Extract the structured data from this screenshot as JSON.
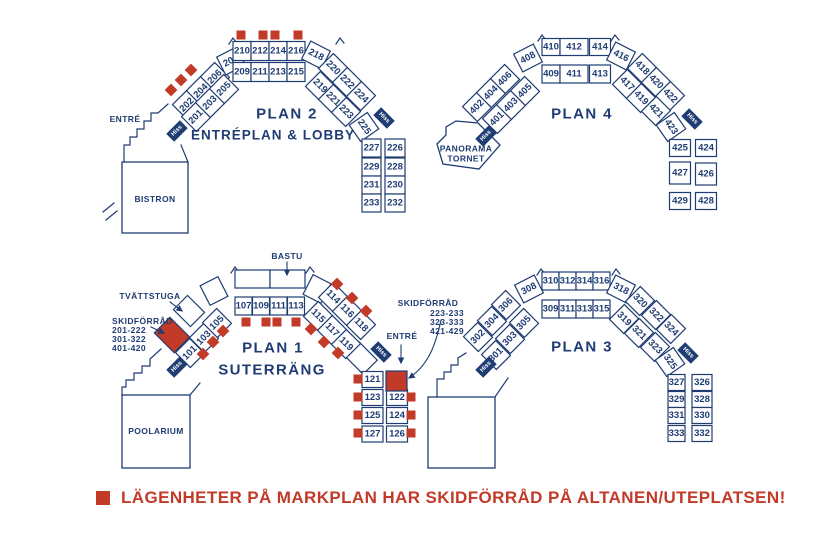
{
  "colors": {
    "navy": "#1f3c73",
    "red": "#c23a28",
    "background": "#ffffff"
  },
  "legend": {
    "text": "LÄGENHETER PÅ MARKPLAN HAR SKIDFÖRRÅD PÅ ALTANEN/UTEPLATSEN!"
  },
  "labels": {
    "hiss": "Hiss",
    "entre_plan2": "ENTRÉ",
    "entre_plan1": "ENTRÉ",
    "bistron": "BISTRON",
    "poolarium": "POOLARIUM",
    "panorama_tornet": "PANORAMA\nTORNET",
    "bastu": "BASTU",
    "tvattstuga": "TVÄTTSTUGA",
    "skidforrad_left": {
      "title": "SKIDFÖRRÅD",
      "lines": [
        "201-222",
        "301-322",
        "401-420"
      ]
    },
    "skidforrad_right": {
      "title": "SKIDFÖRRÅD",
      "lines": [
        "223-233",
        "323-333",
        "421-429"
      ]
    }
  },
  "plans": [
    {
      "id": "plan2",
      "title": "PLAN 2",
      "subtitle": "ENTRÉPLAN & LOBBY",
      "rooms": {
        "left_outer": [
          "202",
          "204",
          "206"
        ],
        "left_inner": [
          "201",
          "203",
          "205"
        ],
        "left_connector": [
          "208"
        ],
        "top_outer": [
          "210",
          "212",
          "214",
          "216"
        ],
        "top_inner": [
          "209",
          "211",
          "213",
          "215"
        ],
        "right_connector": [
          "218"
        ],
        "right_outer": [
          "220",
          "222",
          "224"
        ],
        "right_inner": [
          "219",
          "221",
          "223"
        ],
        "inner_end": [
          "225"
        ],
        "col_left": [
          "227",
          "229",
          "231",
          "233"
        ],
        "col_right": [
          "226",
          "228",
          "230",
          "232"
        ]
      }
    },
    {
      "id": "plan4",
      "title": "PLAN 4",
      "subtitle": "",
      "rooms": {
        "left_outer": [
          "402",
          "404",
          "406"
        ],
        "left_inner": [
          "401",
          "403",
          "405"
        ],
        "left_connector": [
          "408"
        ],
        "top_outer": [
          "410",
          "412",
          "414"
        ],
        "top_inner": [
          "409",
          "411",
          "413"
        ],
        "right_connector": [
          "416"
        ],
        "right_outer": [
          "418",
          "420",
          "422"
        ],
        "right_inner": [
          "417",
          "419",
          "421"
        ],
        "inner_end": [
          "423"
        ],
        "col_left": [
          "425",
          "427",
          "429"
        ],
        "col_right": [
          "424",
          "426",
          "428"
        ]
      }
    },
    {
      "id": "plan1",
      "title": "PLAN 1",
      "subtitle": "SUTERRÄNG",
      "rooms": {
        "left_inner": [
          "101",
          "103",
          "105"
        ],
        "top_inner": [
          "107",
          "109",
          "111",
          "113"
        ],
        "right_outer": [
          "114",
          "116",
          "118"
        ],
        "right_inner": [
          "115",
          "117",
          "119"
        ],
        "col_left": [
          "121",
          "123",
          "125",
          "127"
        ],
        "col_right": [
          "122",
          "124",
          "126"
        ]
      }
    },
    {
      "id": "plan3",
      "title": "PLAN 3",
      "subtitle": "",
      "rooms": {
        "left_outer": [
          "302",
          "304",
          "306"
        ],
        "left_inner": [
          "301",
          "303",
          "305"
        ],
        "left_connector": [
          "308"
        ],
        "top_outer": [
          "310",
          "312",
          "314",
          "316"
        ],
        "top_inner": [
          "309",
          "311",
          "313",
          "315"
        ],
        "right_connector": [
          "318"
        ],
        "right_outer": [
          "320",
          "322",
          "324"
        ],
        "right_inner": [
          "319",
          "321",
          "323"
        ],
        "inner_end": [
          "325"
        ],
        "col_left": [
          "327",
          "329",
          "331",
          "333"
        ],
        "col_right": [
          "326",
          "328",
          "330",
          "332"
        ]
      }
    }
  ]
}
